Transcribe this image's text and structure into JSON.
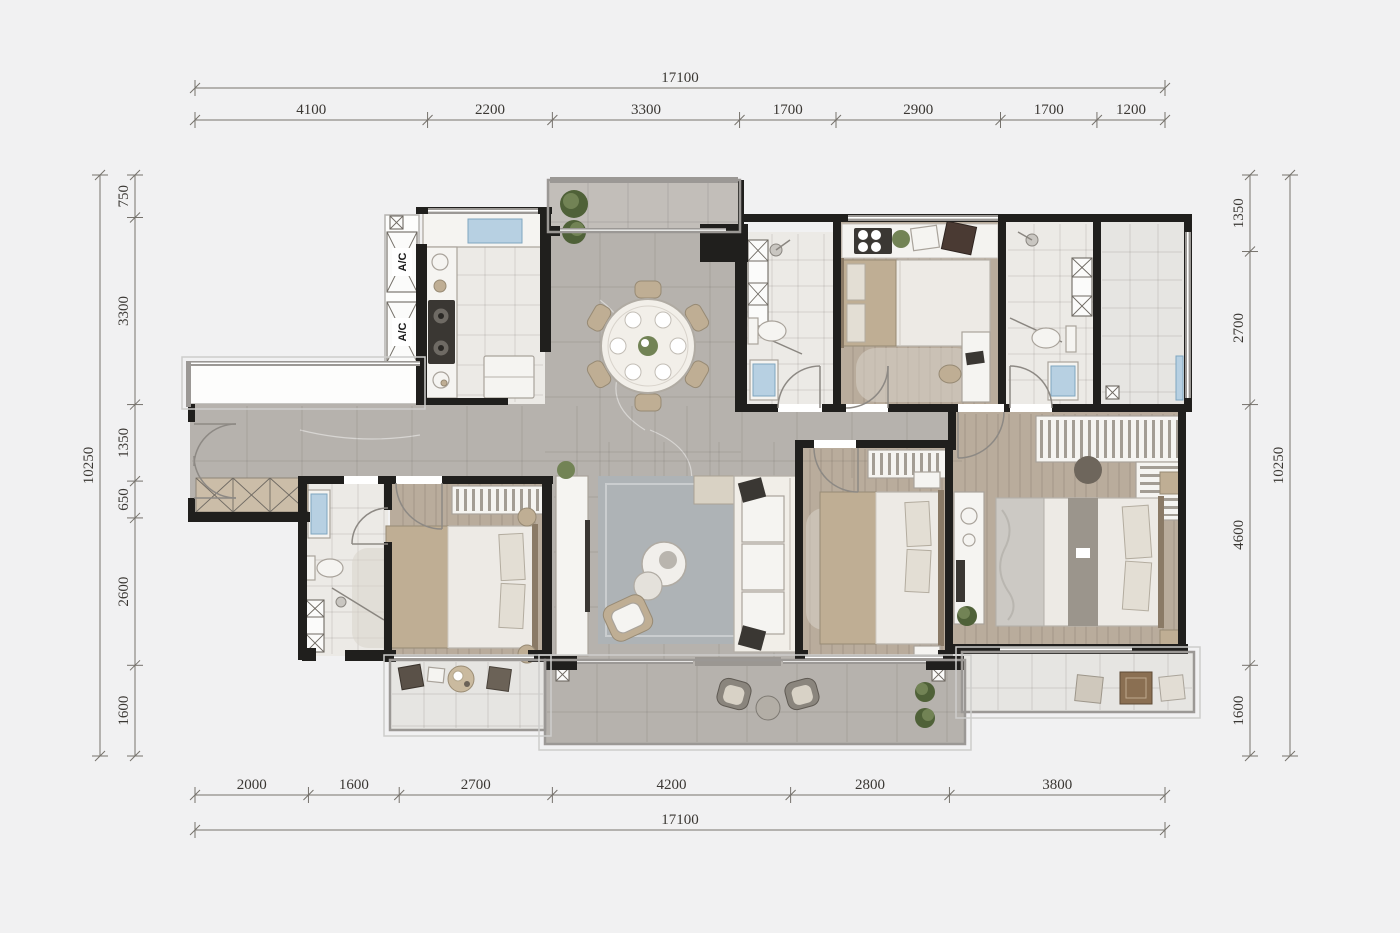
{
  "dimensions": {
    "top": {
      "total": "17100",
      "segments": [
        "4100",
        "2200",
        "3300",
        "1700",
        "2900",
        "1700",
        "1200"
      ]
    },
    "bottom": {
      "total": "17100",
      "segments": [
        "2000",
        "1600",
        "2700",
        "4200",
        "2800",
        "3800"
      ]
    },
    "left": {
      "total": "10250",
      "segments": [
        "750",
        "3300",
        "1350",
        "650",
        "2600",
        "1600"
      ]
    },
    "right": {
      "total": "10250",
      "segments": [
        "1350",
        "2700",
        "4600",
        "1600"
      ]
    }
  },
  "labels": {
    "ac_unit": "A/C"
  },
  "colors": {
    "background": "#f1f1f2",
    "wall": "#201f1d",
    "window_frame": "#9b9895",
    "marble_floor": "#b6b2ad",
    "marble_floor_light": "#c2beb9",
    "wood_floor": "#b9ac9c",
    "tile_floor": "#eceae6",
    "furniture_white": "#f5f4f1",
    "furniture_stroke": "#a9a39b",
    "furniture_tan": "#bfae94",
    "dark_item": "#3a3733",
    "plant_green": "#728355",
    "plant_green_dark": "#4f6138",
    "accent_blue": "#b7d0e2",
    "rug_gray": "#aeb3b6",
    "dimension_line": "#76726c",
    "dimension_text": "#3a3733"
  }
}
